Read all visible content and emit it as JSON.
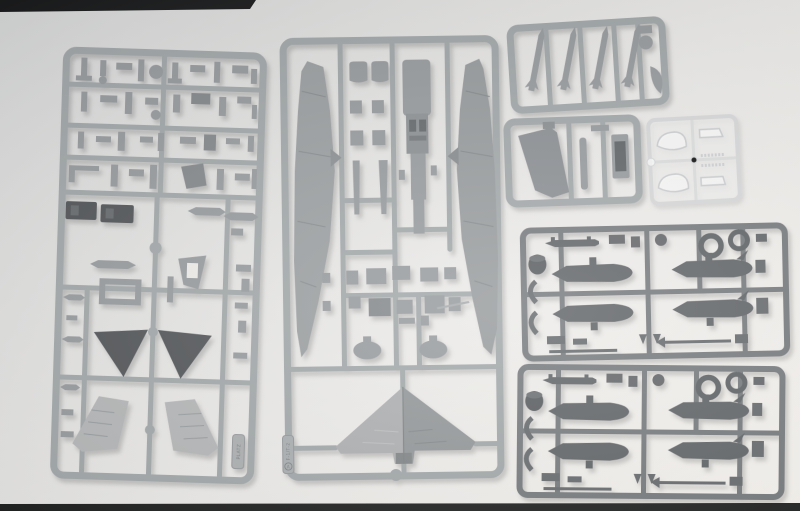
{
  "photo": {
    "subject": "Injection-molded plastic sprues (runner frames) of a 1/144 scale model jet aircraft kit photographed on a white background",
    "kit_marking": "F-1/T-2",
    "maker_marking": "PLATZ",
    "background_top_color": "#d2d3d3",
    "background_bottom_color": "#f4f1ec",
    "edge_bar_color": "#101010",
    "gray_plastic_color": "#9aa0a2",
    "dark_plastic_color": "#6b6f72",
    "clear_plastic_color": "#e8e9e9"
  },
  "sprues": [
    {
      "name": "detail parts sprue",
      "position": "left",
      "plastic": "gray",
      "marking": "PLATZ",
      "parts": [
        "landing gear struts",
        "gear doors",
        "two dark ejection seats",
        "slender tank halves",
        "rectangular frame part",
        "two dark tailplanes",
        "two light upper wing halves",
        "many small fittings"
      ]
    },
    {
      "name": "main airframe sprue",
      "position": "center",
      "plastic": "gray",
      "marking": "F-1/T-2",
      "marking_letter": "A",
      "parts": [
        "left fuselage half",
        "right fuselage half",
        "intake lips",
        "underwing pylons",
        "fuselage spine with engine detail",
        "grid of small hatch squares",
        "two gear pods",
        "one-piece delta wing"
      ]
    },
    {
      "name": "missile sprue",
      "position": "top-right",
      "plastic": "gray",
      "parts": [
        "four slender missiles",
        "round radome",
        "curved fairing"
      ]
    },
    {
      "name": "fin sprue",
      "position": "mid-right",
      "plastic": "gray",
      "parts": [
        "vertical fin",
        "blade part",
        "hatch panel with recess"
      ]
    },
    {
      "name": "clear parts sprue",
      "position": "mid-right outer",
      "plastic": "clear",
      "parts": [
        "two canopy sections",
        "two windscreen pieces",
        "serrated clear strips"
      ]
    },
    {
      "name": "drop tank sprue 1",
      "position": "right middle",
      "plastic": "dark gray",
      "parts": [
        "four drop tank halves",
        "two nozzle rings",
        "finned probe",
        "dark knob",
        "C-brackets",
        "thin rods and fins"
      ]
    },
    {
      "name": "drop tank sprue 2",
      "position": "bottom right",
      "plastic": "dark gray",
      "parts": [
        "four drop tank halves",
        "two nozzle rings",
        "finned probe",
        "dark knob",
        "C-brackets",
        "thin rods and fins"
      ]
    }
  ]
}
